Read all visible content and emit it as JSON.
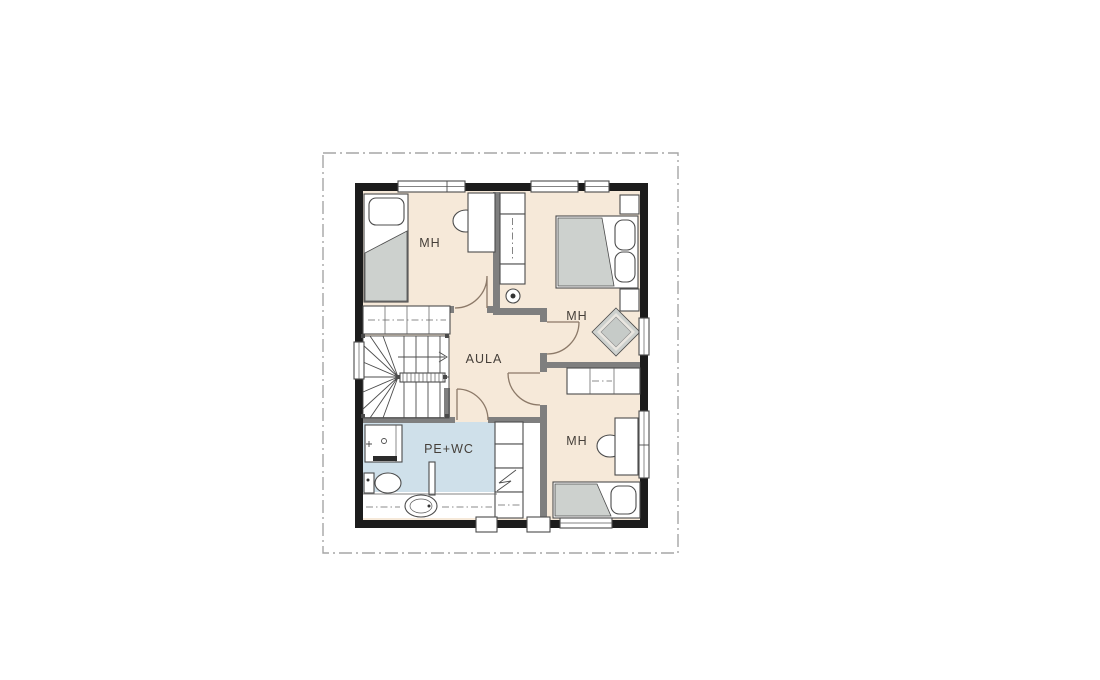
{
  "colors": {
    "background": "#ffffff",
    "wall": "#1c1c1c",
    "iwall": "#7f7f7f",
    "floor": "#f6e9d9",
    "wet": "#cfe0ea",
    "fgray": "#cdd1ce",
    "line": "#4c4c4c",
    "boundary": "#a6a6a6",
    "door": "#8c7968",
    "text": "#453f39"
  },
  "plan": {
    "rooms": [
      {
        "id": "bedroom-top-left",
        "label": "MH"
      },
      {
        "id": "bedroom-top-right",
        "label": "MH"
      },
      {
        "id": "bedroom-bottom-right",
        "label": "MH"
      },
      {
        "id": "hall",
        "label": "AULA"
      },
      {
        "id": "bath-utility",
        "label": "PE+WC"
      }
    ]
  }
}
